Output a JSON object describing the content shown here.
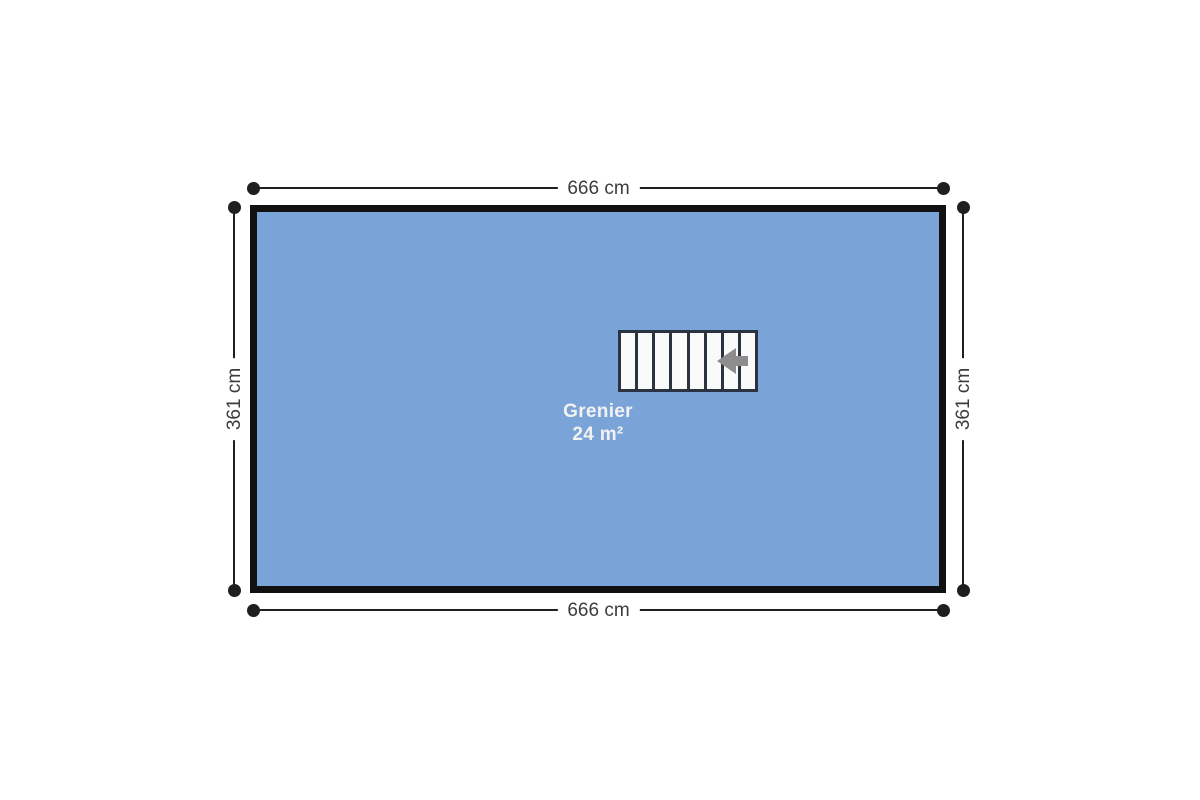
{
  "floor_plan": {
    "room": {
      "name": "Grenier",
      "area": "24 m²",
      "width_label_top": "666 cm",
      "width_label_bottom": "666 cm",
      "height_label_left": "361 cm",
      "height_label_right": "361 cm"
    },
    "staircase": {
      "treads": 8,
      "direction": "left"
    },
    "colors": {
      "background": "#ffffff",
      "room_fill": "#7aa3d8",
      "room_border": "#111111",
      "room_label_text": "#f2f2f2",
      "dimension_line": "#1f1f1f",
      "dimension_text": "#3c3c3c",
      "stair_border": "#2b3240",
      "stair_fill": "#fafafa",
      "arrow": "#8d8d8d"
    }
  }
}
